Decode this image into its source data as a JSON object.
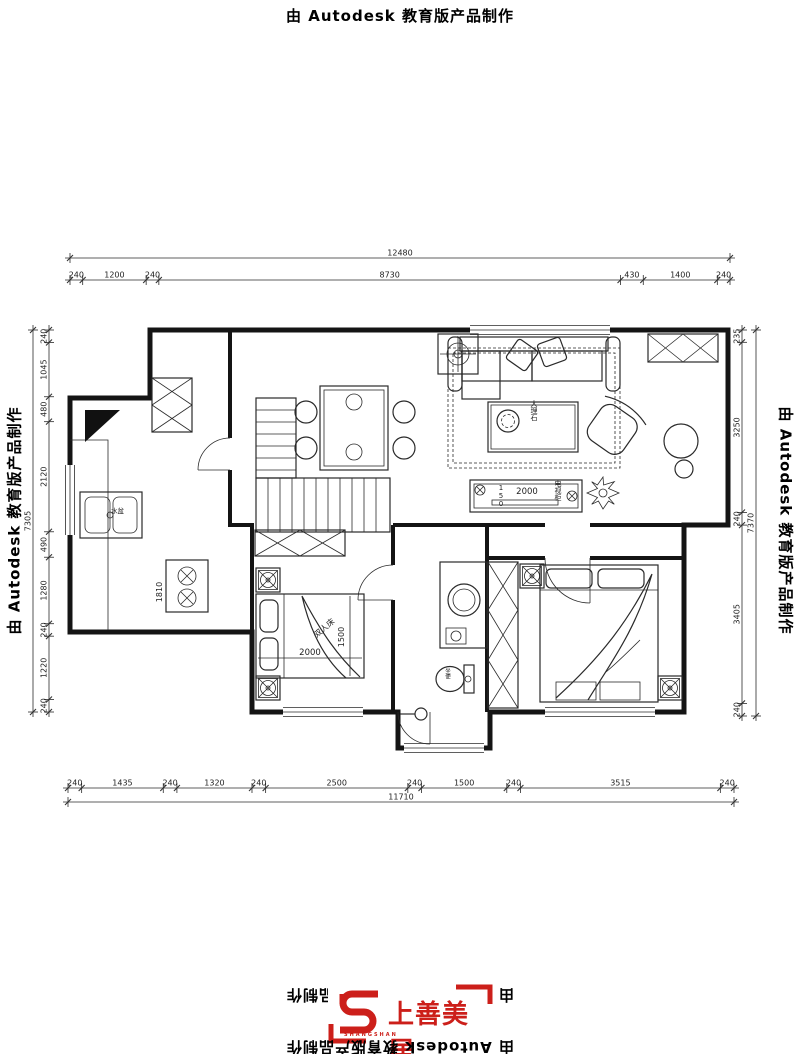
{
  "banner": {
    "autodesk_text": "由 Autodesk 教育版产品制作"
  },
  "logo": {
    "brand": "上善美居",
    "latin": "SHANGSHAN",
    "color": "#cc1f1a"
  },
  "dims": {
    "top": {
      "overall": "12480",
      "segments": [
        "240",
        "1200",
        "240",
        "8730",
        "430",
        "1400",
        "240"
      ]
    },
    "bottom": {
      "overall": "11710",
      "segments": [
        "240",
        "1435",
        "240",
        "1320",
        "240",
        "2500",
        "240",
        "1500",
        "240",
        "3515",
        "240"
      ]
    },
    "left": {
      "overall": "7305",
      "segments": [
        "240",
        "1045",
        "480",
        "2120",
        "490",
        "1280",
        "240",
        "1220",
        "240"
      ]
    },
    "right": {
      "overall": "7370",
      "segments": [
        "235",
        "3250",
        "240",
        "3405",
        "240"
      ]
    }
  },
  "labels": {
    "tea_table": "大理石",
    "tv_cabinet": "电视柜",
    "tv_cabinet_w": "2000",
    "tv_cabinet_d": "150",
    "bed1_w": "2000",
    "bed1_d": "1500",
    "bed1": "双人床",
    "kitchen_sink": "水盆",
    "kitchen_dim": "1810",
    "toilet": "坐便"
  },
  "colors": {
    "line": "#1f1f1f",
    "accent_red": "#cc1f1a"
  }
}
